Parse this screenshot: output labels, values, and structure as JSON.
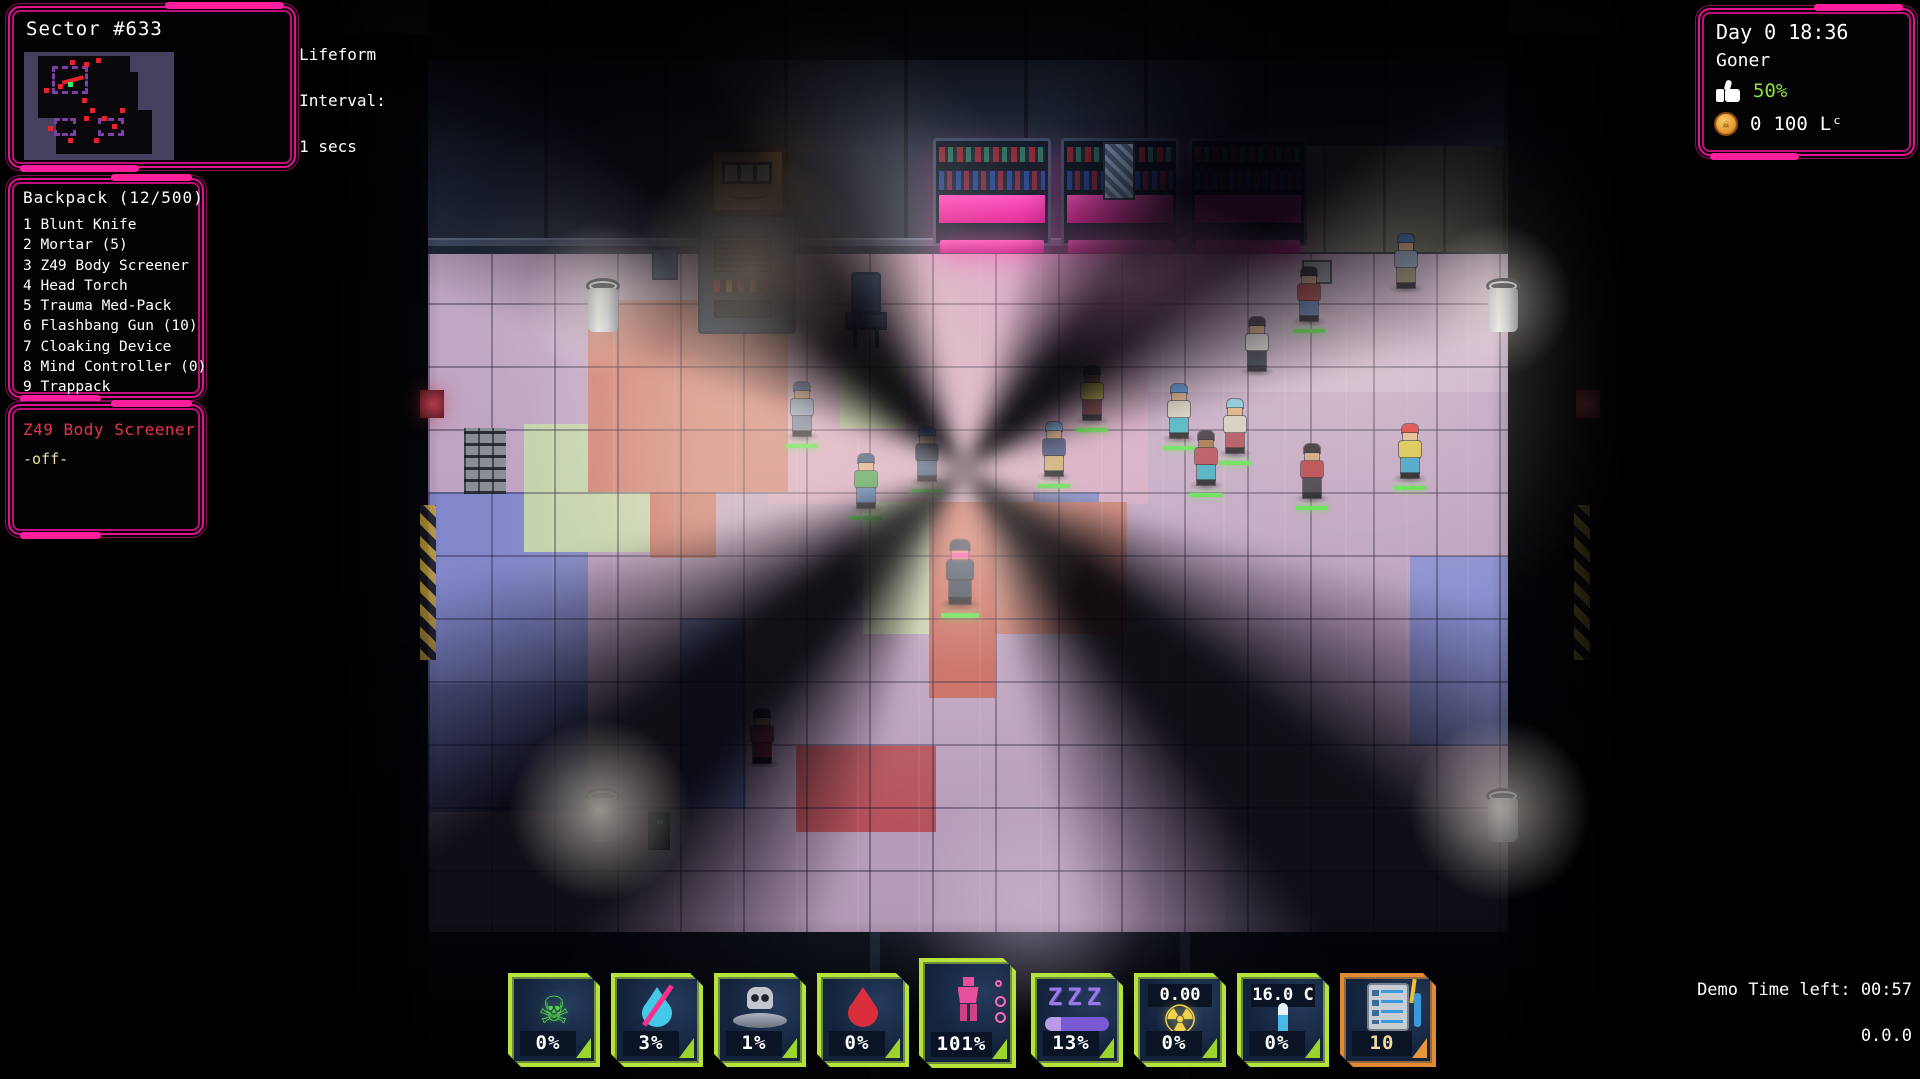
{
  "hud": {
    "sector": {
      "title": "Sector #633",
      "l1": "Lifeform",
      "l2": "Interval:",
      "l3": "1 secs"
    },
    "backpack": {
      "title": "Backpack (12/500)",
      "items": [
        "1 Blunt Knife",
        "2 Mortar (5)",
        "3 Z49 Body Screener",
        "4 Head Torch",
        "5 Trauma Med-Pack",
        "6 Flashbang Gun (10)",
        "7 Cloaking Device",
        "8 Mind Controller (0)",
        "9 Trappack"
      ]
    },
    "equipped": {
      "title": "Z49 Body Screener",
      "state": "-off-"
    },
    "status": {
      "daytime": "Day 0 18:36",
      "player_name": "Goner",
      "approval": "50%",
      "coin_count": "0",
      "credits": "100",
      "currency": "Lᶜ",
      "approval_color": "#8ae63c"
    },
    "gauges": [
      {
        "id": "toxin",
        "value": "0%"
      },
      {
        "id": "thirst",
        "value": "3%"
      },
      {
        "id": "hunger",
        "value": "1%"
      },
      {
        "id": "blood",
        "value": "0%"
      },
      {
        "id": "body",
        "value": "101%"
      },
      {
        "id": "sleep",
        "value": "13%"
      },
      {
        "id": "radiation",
        "value": "0%",
        "top_label": "0.00"
      },
      {
        "id": "temperature",
        "value": "0%",
        "top_label": "16.0 C"
      },
      {
        "id": "tasks",
        "value": "10"
      }
    ],
    "demo": {
      "time_left": "Demo Time left: 00:57",
      "version": "0.0.0"
    },
    "colors": {
      "frame_pink": "#ff1f9c",
      "gauge_green": "#b6e23c",
      "gauge_orange": "#e08a34",
      "neon_magenta": "#ff2fb0"
    }
  },
  "scene": {
    "npcs": [
      {
        "x": 789,
        "y": 382,
        "hair": "#4a5f8e",
        "skin": "#c9a07a",
        "top": "#93a7c9",
        "legs": "#6e7c9c",
        "bar": true,
        "player": false
      },
      {
        "x": 853,
        "y": 454,
        "hair": "#2e4a6e",
        "skin": "#d9ab80",
        "top": "#46a050",
        "legs": "#4a7ab8",
        "bar": true,
        "player": false
      },
      {
        "x": 914,
        "y": 427,
        "hair": "#3a86c9",
        "skin": "#d9ab80",
        "top": "#28344e",
        "legs": "#3c5a88",
        "bar": true,
        "player": false
      },
      {
        "x": 947,
        "y": 545,
        "hair": "#20304a",
        "skin": "#c9a07a",
        "top": "#2c3d58",
        "legs": "#27364e",
        "bar": true,
        "player": true
      },
      {
        "x": 1079,
        "y": 366,
        "hair": "#1f3440",
        "skin": "#8a5a3a",
        "top": "#d9c44a",
        "legs": "#7c3440",
        "bar": true,
        "player": false
      },
      {
        "x": 1041,
        "y": 422,
        "hair": "#6aa8d9",
        "skin": "#d9ab80",
        "top": "#3c4a7a",
        "legs": "#c9a86a",
        "bar": true,
        "player": false
      },
      {
        "x": 1166,
        "y": 384,
        "hair": "#4a8ad9",
        "skin": "#d9ab80",
        "top": "#d8d2c4",
        "legs": "#38b2c4",
        "bar": true,
        "player": false
      },
      {
        "x": 1193,
        "y": 431,
        "hair": "#2a2433",
        "skin": "#9a6a42",
        "top": "#b0424e",
        "legs": "#38a8c0",
        "bar": true,
        "player": false
      },
      {
        "x": 1222,
        "y": 399,
        "hair": "#7ac9e8",
        "skin": "#d9ab80",
        "top": "#cfc9c0",
        "legs": "#a84050",
        "bar": true,
        "player": false
      },
      {
        "x": 1296,
        "y": 267,
        "hair": "#1a1a24",
        "skin": "#d9ab80",
        "top": "#b04040",
        "legs": "#5a7ab8",
        "bar": true,
        "player": false
      },
      {
        "x": 1393,
        "y": 234,
        "hair": "#3a6ab8",
        "skin": "#d9ab80",
        "top": "#8aa2c4",
        "legs": "#968e6e",
        "bar": false,
        "player": false
      },
      {
        "x": 1397,
        "y": 424,
        "hair": "#d93a3a",
        "skin": "#e0b890",
        "top": "#d9c44a",
        "legs": "#38a0c9",
        "bar": true,
        "player": false
      },
      {
        "x": 1244,
        "y": 317,
        "hair": "#2a2433",
        "skin": "#d9ab80",
        "top": "#e6e6e6",
        "legs": "#2c3448",
        "bar": false,
        "player": false
      },
      {
        "x": 749,
        "y": 709,
        "hair": "#3a2a4a",
        "skin": "#c99a70",
        "top": "#8a3048",
        "legs": "#6e2438",
        "bar": false,
        "player": false
      },
      {
        "x": 1299,
        "y": 444,
        "hair": "#241f2e",
        "skin": "#c9a07a",
        "top": "#b23a44",
        "legs": "#3a3442",
        "bar": true,
        "player": false
      }
    ]
  }
}
